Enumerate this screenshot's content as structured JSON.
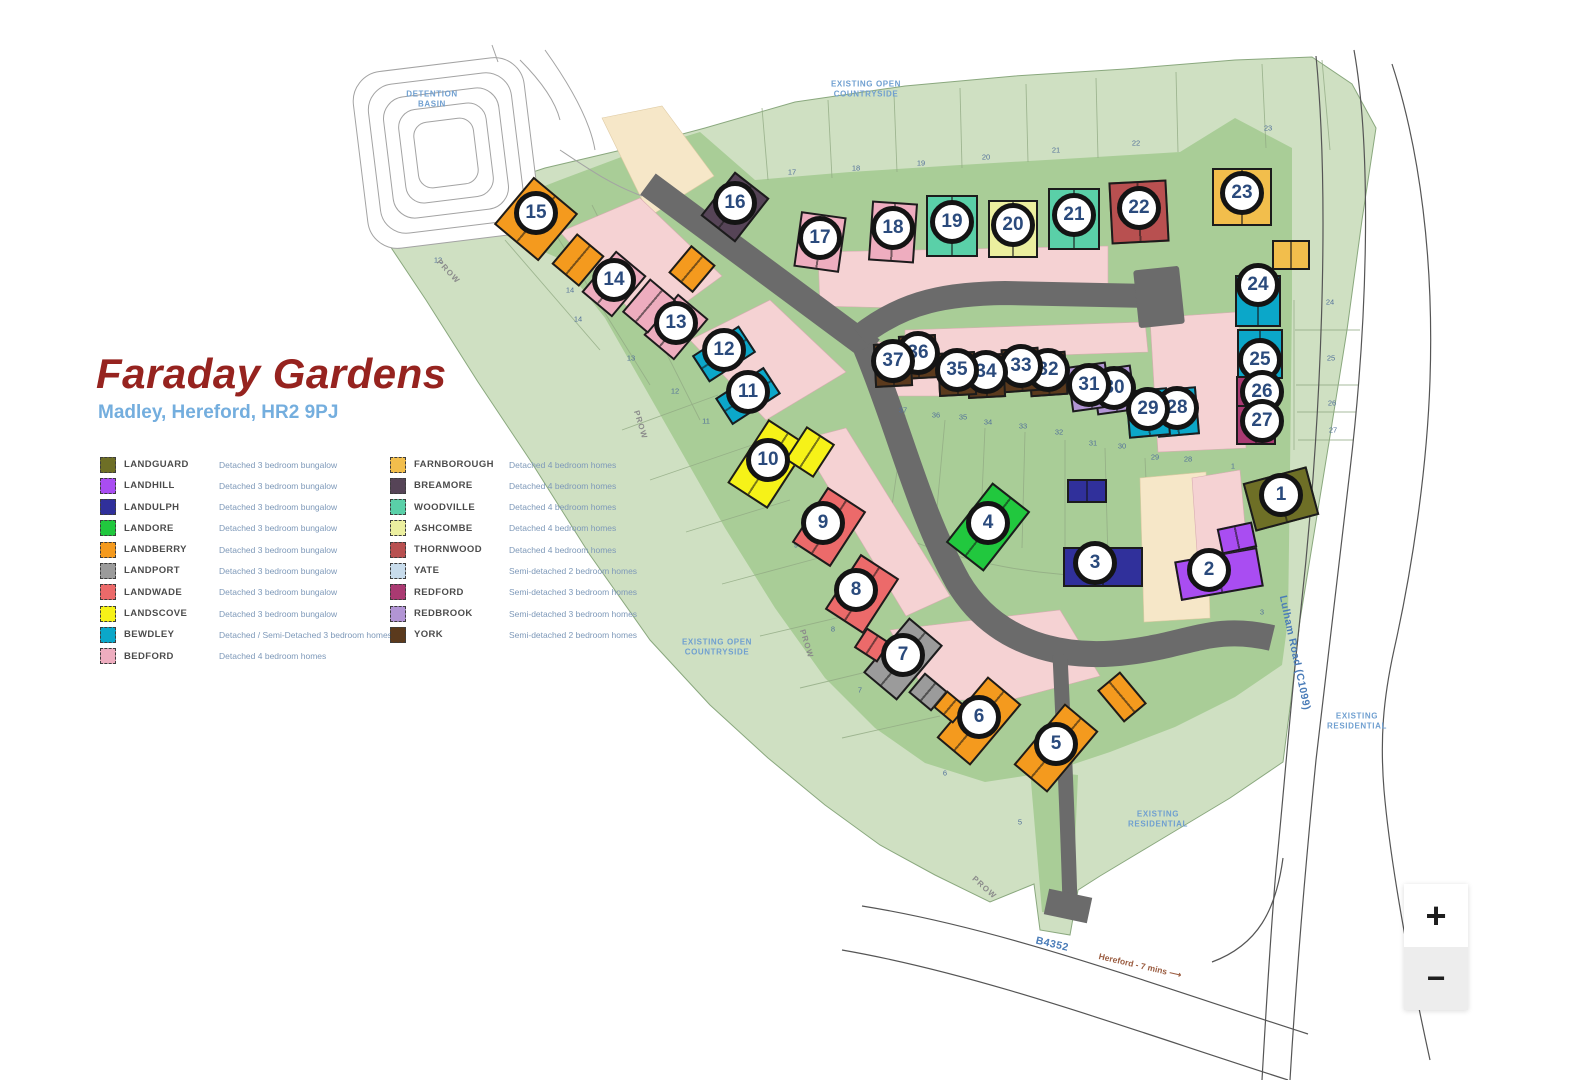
{
  "header": {
    "title": "Faraday Gardens",
    "subtitle": "Madley, Hereford, HR2 9PJ"
  },
  "zoom_controls": {
    "zoom_in": "+",
    "zoom_out": "−"
  },
  "legend": {
    "columns": [
      {
        "items": [
          {
            "name": "LANDGUARD",
            "type": "landguard",
            "description": "Detached 3 bedroom bungalow"
          },
          {
            "name": "LANDHILL",
            "type": "landhill",
            "description": "Detached 3 bedroom bungalow"
          },
          {
            "name": "LANDULPH",
            "type": "landulph",
            "description": "Detached 3 bedroom bungalow"
          },
          {
            "name": "LANDORE",
            "type": "landore",
            "description": "Detached 3 bedroom bungalow"
          },
          {
            "name": "LANDBERRY",
            "type": "landberry",
            "description": "Detached 3 bedroom bungalow"
          },
          {
            "name": "LANDPORT",
            "type": "landport",
            "description": "Detached 3 bedroom bungalow"
          },
          {
            "name": "LANDWADE",
            "type": "landwade",
            "description": "Detached 3 bedroom bungalow"
          },
          {
            "name": "LANDSCOVE",
            "type": "landscove",
            "description": "Detached 3 bedroom bungalow"
          },
          {
            "name": "BEWDLEY",
            "type": "bewdley",
            "description": "Detached / Semi-Detached 3 bedroom homes"
          },
          {
            "name": "BEDFORD",
            "type": "bedford",
            "description": "Detached 4 bedroom homes"
          }
        ]
      },
      {
        "items": [
          {
            "name": "FARNBOROUGH",
            "type": "farnborough",
            "description": "Detached 4 bedroom homes"
          },
          {
            "name": "BREAMORE",
            "type": "breamore",
            "description": "Detached 4 bedroom homes"
          },
          {
            "name": "WOODVILLE",
            "type": "woodville",
            "description": "Detached 4 bedroom homes"
          },
          {
            "name": "ASHCOMBE",
            "type": "ashcombe",
            "description": "Detached 4 bedroom homes"
          },
          {
            "name": "THORNWOOD",
            "type": "thornwood",
            "description": "Detached 4 bedroom homes"
          },
          {
            "name": "YATE",
            "type": "yate",
            "description": "Semi-detached 2 bedroom homes"
          },
          {
            "name": "REDFORD",
            "type": "redford",
            "description": "Semi-detached 3 bedroom homes"
          },
          {
            "name": "REDBROOK",
            "type": "redbrook",
            "description": "Semi-detached 3 bedroom homes"
          },
          {
            "name": "YORK",
            "type": "york",
            "description": "Semi-detached 2 bedroom homes"
          }
        ]
      }
    ]
  },
  "map": {
    "house_colors": {
      "landguard": "#6e6f26",
      "landhill": "#a94df2",
      "landulph": "#30309b",
      "landore": "#21c83e",
      "landberry": "#f49a1e",
      "landport": "#9b9b9b",
      "landwade": "#ec6a6a",
      "landscove": "#f6f218",
      "bewdley": "#0ba7c9",
      "bedford": "#eeadbf",
      "farnborough": "#f2be4c",
      "breamore": "#564457",
      "woodville": "#5ad0a8",
      "ashcombe": "#ecef9f",
      "thornwood": "#b85050",
      "yate": "#c8dcec",
      "redford": "#aa3a72",
      "redbrook": "#b295d5",
      "york": "#5b3a1d"
    },
    "labels": [
      {
        "text": "DETENTION\nBASIN",
        "x": 432,
        "y": 100,
        "r": 0,
        "cls": "ml-area",
        "name": "label-detention-basin"
      },
      {
        "text": "EXISTING OPEN\nCOUNTRYSIDE",
        "x": 866,
        "y": 90,
        "r": 0,
        "cls": "ml-area",
        "name": "label-existing-open-countryside-top"
      },
      {
        "text": "EXISTING OPEN\nCOUNTRYSIDE",
        "x": 717,
        "y": 648,
        "r": 0,
        "cls": "ml-area",
        "name": "label-existing-open-countryside-left"
      },
      {
        "text": "EXISTING\nRESIDENTIAL",
        "x": 1357,
        "y": 722,
        "r": 0,
        "cls": "ml-area",
        "name": "label-existing-residential-right"
      },
      {
        "text": "EXISTING\nRESIDENTIAL",
        "x": 1158,
        "y": 820,
        "r": 0,
        "cls": "ml-area",
        "name": "label-existing-residential-bottom"
      },
      {
        "text": "Lulham Road (C1099)",
        "x": 1294,
        "y": 653,
        "r": 78,
        "cls": "ml-road",
        "name": "label-lulham-road"
      },
      {
        "text": "B4352",
        "x": 1052,
        "y": 945,
        "r": 13,
        "cls": "ml-road",
        "name": "label-b4352"
      },
      {
        "text": "Hereford - 7 mins   ⟶",
        "x": 1140,
        "y": 966,
        "r": 13,
        "cls": "ml-dir",
        "name": "label-hereford-direction"
      },
      {
        "text": "PROW",
        "x": 448,
        "y": 272,
        "r": 47,
        "cls": "ml-prow",
        "name": "label-prow-1"
      },
      {
        "text": "PROW",
        "x": 640,
        "y": 425,
        "r": 73,
        "cls": "ml-prow",
        "name": "label-prow-2"
      },
      {
        "text": "PROW",
        "x": 806,
        "y": 644,
        "r": 73,
        "cls": "ml-prow",
        "name": "label-prow-3"
      },
      {
        "text": "PROW",
        "x": 984,
        "y": 888,
        "r": 42,
        "cls": "ml-prow",
        "name": "label-prow-4"
      }
    ],
    "parcel_numbers": [
      {
        "t": "17",
        "x": 792,
        "y": 172
      },
      {
        "t": "18",
        "x": 856,
        "y": 168
      },
      {
        "t": "19",
        "x": 921,
        "y": 163
      },
      {
        "t": "20",
        "x": 986,
        "y": 157
      },
      {
        "t": "21",
        "x": 1056,
        "y": 150
      },
      {
        "t": "22",
        "x": 1136,
        "y": 143
      },
      {
        "t": "23",
        "x": 1268,
        "y": 128
      },
      {
        "t": "24",
        "x": 1330,
        "y": 302
      },
      {
        "t": "25",
        "x": 1331,
        "y": 358
      },
      {
        "t": "26",
        "x": 1332,
        "y": 403
      },
      {
        "t": "27",
        "x": 1333,
        "y": 430
      },
      {
        "t": "28",
        "x": 1188,
        "y": 459
      },
      {
        "t": "29",
        "x": 1155,
        "y": 457
      },
      {
        "t": "30",
        "x": 1122,
        "y": 446
      },
      {
        "t": "31",
        "x": 1093,
        "y": 443
      },
      {
        "t": "32",
        "x": 1059,
        "y": 432
      },
      {
        "t": "33",
        "x": 1023,
        "y": 426
      },
      {
        "t": "34",
        "x": 988,
        "y": 422
      },
      {
        "t": "35",
        "x": 963,
        "y": 417
      },
      {
        "t": "36",
        "x": 936,
        "y": 415
      },
      {
        "t": "37",
        "x": 903,
        "y": 410
      },
      {
        "t": "1",
        "x": 1233,
        "y": 466
      },
      {
        "t": "3",
        "x": 1262,
        "y": 612
      },
      {
        "t": "14",
        "x": 578,
        "y": 319
      },
      {
        "t": "13",
        "x": 631,
        "y": 358
      },
      {
        "t": "12",
        "x": 675,
        "y": 391
      },
      {
        "t": "11",
        "x": 706,
        "y": 421
      },
      {
        "t": "10",
        "x": 740,
        "y": 482
      },
      {
        "t": "9",
        "x": 796,
        "y": 545
      },
      {
        "t": "8",
        "x": 833,
        "y": 629
      },
      {
        "t": "7",
        "x": 860,
        "y": 690
      },
      {
        "t": "6",
        "x": 945,
        "y": 773
      },
      {
        "t": "5",
        "x": 1020,
        "y": 822
      },
      {
        "t": "12",
        "x": 438,
        "y": 260
      },
      {
        "t": "14",
        "x": 570,
        "y": 290
      }
    ],
    "plots": [
      {
        "number": "1",
        "x": 1281,
        "y": 495,
        "type": "landguard",
        "a": -15,
        "w": 66,
        "h": 50
      },
      {
        "number": "2",
        "x": 1209,
        "y": 570,
        "type": "landhill",
        "a": -10,
        "w": 84,
        "h": 40,
        "dx": 10
      },
      {
        "number": "3",
        "x": 1095,
        "y": 563,
        "type": "landulph",
        "a": 0,
        "w": 80,
        "h": 40,
        "dx": 8
      },
      {
        "number": "4",
        "x": 988,
        "y": 523,
        "type": "landore",
        "a": 38,
        "w": 48,
        "h": 76
      },
      {
        "number": "5",
        "x": 1056,
        "y": 744,
        "type": "landberry",
        "a": 40,
        "w": 44,
        "h": 80
      },
      {
        "number": "6",
        "x": 979,
        "y": 717,
        "type": "landberry",
        "a": 40,
        "w": 44,
        "h": 80
      },
      {
        "number": "7",
        "x": 903,
        "y": 655,
        "type": "landport",
        "a": 40,
        "w": 44,
        "h": 72
      },
      {
        "number": "8",
        "x": 856,
        "y": 590,
        "type": "landwade",
        "a": 33,
        "w": 46,
        "h": 66,
        "dx": 6
      },
      {
        "number": "9",
        "x": 823,
        "y": 523,
        "type": "landwade",
        "a": 33,
        "w": 46,
        "h": 66,
        "dx": 6
      },
      {
        "number": "10",
        "x": 768,
        "y": 460,
        "type": "landscove",
        "a": 33,
        "w": 48,
        "h": 76
      },
      {
        "number": "11",
        "x": 748,
        "y": 392,
        "type": "bewdley",
        "a": 57,
        "w": 32,
        "h": 58
      },
      {
        "number": "12",
        "x": 724,
        "y": 350,
        "type": "bewdley",
        "a": 57,
        "w": 32,
        "h": 56
      },
      {
        "number": "13",
        "x": 676,
        "y": 323,
        "type": "bedford",
        "a": 40,
        "w": 40,
        "h": 54
      },
      {
        "number": "14",
        "x": 614,
        "y": 280,
        "type": "bedford",
        "a": 40,
        "w": 40,
        "h": 54
      },
      {
        "number": "15",
        "x": 536,
        "y": 213,
        "type": "landberry",
        "a": 40,
        "w": 58,
        "h": 62,
        "dy": 6
      },
      {
        "number": "16",
        "x": 735,
        "y": 203,
        "type": "breamore",
        "a": 38,
        "w": 44,
        "h": 56
      },
      {
        "number": "17",
        "x": 820,
        "y": 238,
        "type": "bedford",
        "a": 8,
        "w": 46,
        "h": 56
      },
      {
        "number": "18",
        "x": 893,
        "y": 228,
        "type": "bedford",
        "a": 4,
        "w": 46,
        "h": 60
      },
      {
        "number": "19",
        "x": 952,
        "y": 222,
        "type": "woodville",
        "a": 0,
        "w": 52,
        "h": 62
      },
      {
        "number": "20",
        "x": 1013,
        "y": 225,
        "type": "ashcombe",
        "a": 0,
        "w": 50,
        "h": 58
      },
      {
        "number": "21",
        "x": 1074,
        "y": 215,
        "type": "woodville",
        "a": 0,
        "w": 52,
        "h": 62
      },
      {
        "number": "22",
        "x": 1139,
        "y": 208,
        "type": "thornwood",
        "a": -3,
        "w": 58,
        "h": 62
      },
      {
        "number": "23",
        "x": 1242,
        "y": 193,
        "type": "farnborough",
        "a": 0,
        "w": 60,
        "h": 58
      },
      {
        "number": "24",
        "x": 1258,
        "y": 285,
        "type": "bewdley",
        "a": 0,
        "w": 46,
        "h": 52,
        "dy": 16
      },
      {
        "number": "25",
        "x": 1260,
        "y": 360,
        "type": "bewdley",
        "a": 0,
        "w": 46,
        "h": 50,
        "dy": -6
      },
      {
        "number": "26",
        "x": 1262,
        "y": 392,
        "type": "redford",
        "a": 0,
        "w": 40,
        "h": 40,
        "dx": -6
      },
      {
        "number": "27",
        "x": 1262,
        "y": 421,
        "type": "redford",
        "a": 0,
        "w": 40,
        "h": 40,
        "dx": -6
      },
      {
        "number": "28",
        "x": 1177,
        "y": 408,
        "type": "bewdley",
        "a": -5,
        "w": 42,
        "h": 48,
        "dy": 4
      },
      {
        "number": "29",
        "x": 1148,
        "y": 409,
        "type": "bewdley",
        "a": -5,
        "w": 42,
        "h": 48,
        "dy": 4
      },
      {
        "number": "30",
        "x": 1114,
        "y": 388,
        "type": "redbrook",
        "a": -8,
        "w": 40,
        "h": 46,
        "dy": 2
      },
      {
        "number": "31",
        "x": 1089,
        "y": 385,
        "type": "redbrook",
        "a": -8,
        "w": 40,
        "h": 46,
        "dy": 2
      },
      {
        "number": "32",
        "x": 1048,
        "y": 370,
        "type": "york",
        "a": -4,
        "w": 38,
        "h": 44
      },
      {
        "number": "33",
        "x": 1021,
        "y": 366,
        "type": "york",
        "a": -4,
        "w": 38,
        "h": 44
      },
      {
        "number": "34",
        "x": 986,
        "y": 372,
        "type": "york",
        "a": -3,
        "w": 38,
        "h": 44
      },
      {
        "number": "35",
        "x": 957,
        "y": 370,
        "type": "york",
        "a": -3,
        "w": 38,
        "h": 44
      },
      {
        "number": "36",
        "x": 918,
        "y": 353,
        "type": "york",
        "a": -3,
        "w": 38,
        "h": 44
      },
      {
        "number": "37",
        "x": 893,
        "y": 361,
        "type": "york",
        "a": -3,
        "w": 38,
        "h": 44
      }
    ],
    "extra_houses": [
      {
        "type": "landulph",
        "x": 1087,
        "y": 487,
        "a": 0,
        "w": 40,
        "h": 24
      },
      {
        "type": "landhill",
        "x": 1237,
        "y": 534,
        "a": -12,
        "w": 36,
        "h": 26
      },
      {
        "type": "farnborough",
        "x": 1291,
        "y": 251,
        "a": 0,
        "w": 38,
        "h": 30
      },
      {
        "type": "bedford",
        "x": 649,
        "y": 302,
        "a": 40,
        "w": 34,
        "h": 44
      },
      {
        "type": "landberry",
        "x": 578,
        "y": 256,
        "a": 40,
        "w": 36,
        "h": 40
      },
      {
        "type": "landberry",
        "x": 692,
        "y": 265,
        "a": 40,
        "w": 32,
        "h": 36
      },
      {
        "type": "landport",
        "x": 928,
        "y": 688,
        "a": 40,
        "w": 30,
        "h": 26
      },
      {
        "type": "landberry",
        "x": 950,
        "y": 703,
        "a": 40,
        "w": 26,
        "h": 22
      },
      {
        "type": "landwade",
        "x": 872,
        "y": 641,
        "a": 33,
        "w": 28,
        "h": 24
      },
      {
        "type": "landberry",
        "x": 1122,
        "y": 693,
        "a": -40,
        "w": 30,
        "h": 42
      },
      {
        "type": "landscove",
        "x": 810,
        "y": 448,
        "a": 33,
        "w": 34,
        "h": 40
      }
    ]
  }
}
